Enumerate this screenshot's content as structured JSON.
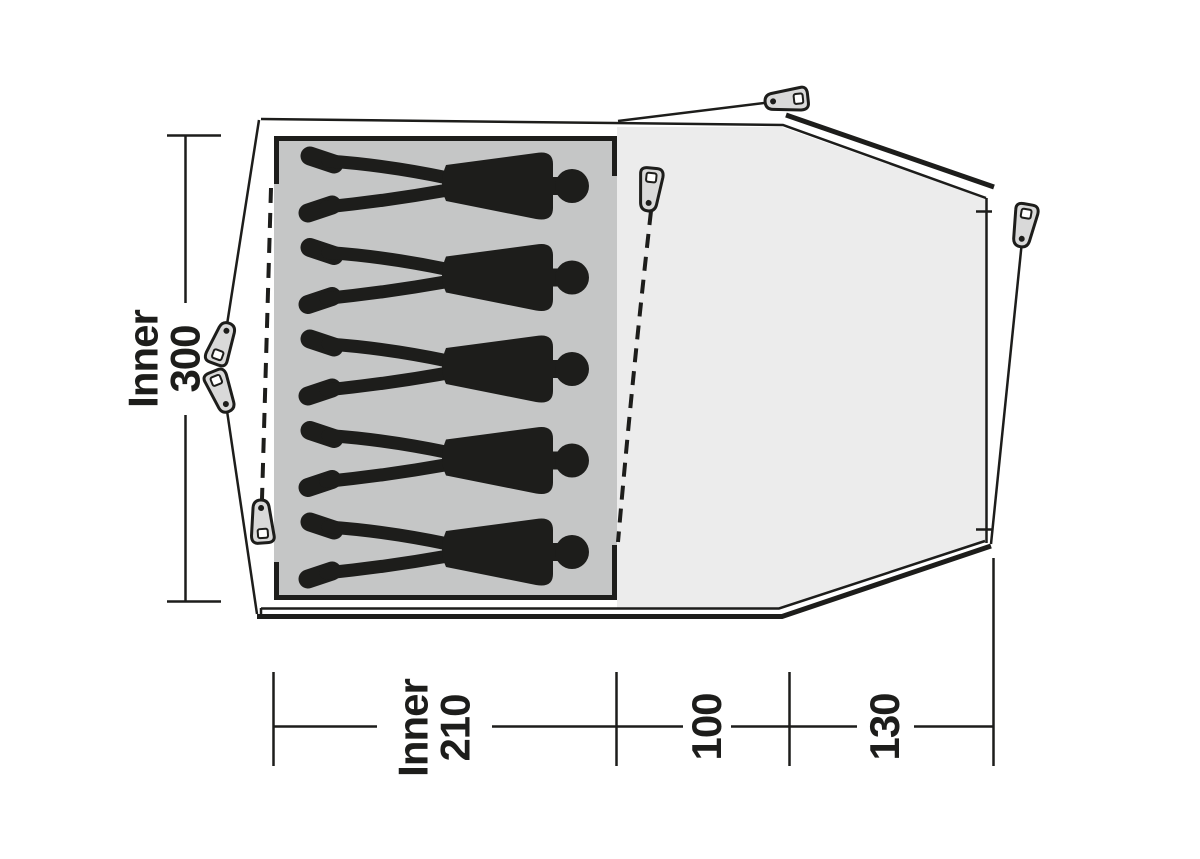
{
  "diagram": {
    "subject": "tent floor plan, top view",
    "areas": {
      "inner_tent": "sleeping cabin with person silhouettes",
      "living_area": "front living / porch area"
    }
  },
  "labels": {
    "depth": {
      "prefix": "Inner",
      "value": "300"
    },
    "inner_width": {
      "prefix": "Inner",
      "value": "210"
    },
    "mid_width": {
      "value": "100"
    },
    "front_width": {
      "value": "130"
    }
  },
  "persons": {
    "count": 5
  },
  "pegs": {
    "count": 6
  },
  "colors": {
    "ink": "#1d1d1b",
    "inner_fill": "#c5c6c6",
    "living_fill": "#ececec",
    "peg_fill": "#d9d9d9"
  },
  "icons": {
    "peg": "tent-peg-icon",
    "person": "person-silhouette-icon"
  }
}
